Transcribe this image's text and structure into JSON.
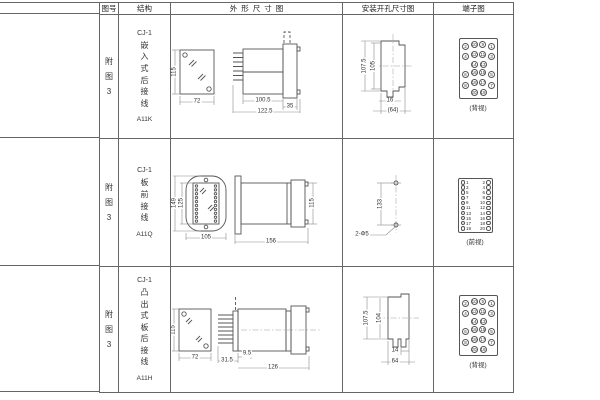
{
  "header": {
    "fig_no": "图号",
    "structure": "结构",
    "outline": "外形尺寸图",
    "mounting": "安装开孔尺寸图",
    "terminal": "端子图"
  },
  "ink": {
    "line_color": "#555555",
    "text_color": "#333333"
  },
  "rows": [
    {
      "fig_no": "附图3",
      "series": "CJ-1",
      "structure": "嵌入式后接线",
      "model": "A11K",
      "outline_dims": {
        "front_height": "115",
        "front_width": "72",
        "body_depth": "100.5",
        "total_depth": "122.5",
        "flange_depth": "35"
      },
      "mounting_dims": {
        "outer_height": "107.5",
        "inner_height": "105",
        "slot_width": "16",
        "overall_width": "(64)"
      },
      "terminal": {
        "view": "(背视)",
        "layout": "staggered",
        "pins": [
          [
            "2",
            "10",
            "9",
            "1"
          ],
          [
            "4",
            "12",
            "11",
            "3"
          ],
          [
            "14",
            "13"
          ],
          [
            "6",
            "16",
            "15",
            "5"
          ],
          [
            "8",
            "18",
            "17",
            "7"
          ],
          [
            "20",
            "19"
          ]
        ]
      }
    },
    {
      "fig_no": "附图3",
      "series": "CJ-1",
      "structure": "板前接线",
      "model": "A11Q",
      "outline_dims": {
        "front_outer_height": "149",
        "front_inner_height": "125",
        "front_width": "105",
        "total_depth": "156",
        "side_height": "115"
      },
      "mounting_dims": {
        "hole_spacing": "133",
        "hole_label": "2-Φ5"
      },
      "terminal": {
        "view": "(前视)",
        "layout": "paired",
        "pins": [
          [
            "1",
            "2"
          ],
          [
            "3",
            "4"
          ],
          [
            "5",
            "6"
          ],
          [
            "7",
            "8"
          ],
          [
            "9",
            "10"
          ],
          [
            "11",
            "12"
          ],
          [
            "13",
            "14"
          ],
          [
            "15",
            "16"
          ],
          [
            "17",
            "18"
          ],
          [
            "19",
            "20"
          ]
        ]
      }
    },
    {
      "fig_no": "附图3",
      "series": "CJ-1",
      "structure": "凸出式板后接线",
      "model": "A11H",
      "outline_dims": {
        "front_height": "115",
        "front_width": "72",
        "pin_depth": "31.5",
        "gap_depth": "9.5",
        "body_depth": "126"
      },
      "mounting_dims": {
        "outer_height": "107.5",
        "inner_height": "104",
        "slot_width": "14",
        "overall_width": "64"
      },
      "terminal": {
        "view": "(背视)",
        "layout": "staggered",
        "pins": [
          [
            "2",
            "10",
            "9",
            "1"
          ],
          [
            "4",
            "12",
            "11",
            "3"
          ],
          [
            "14",
            "13"
          ],
          [
            "6",
            "16",
            "15",
            "5"
          ],
          [
            "8",
            "18",
            "17",
            "7"
          ],
          [
            "20",
            "19"
          ]
        ]
      }
    }
  ]
}
